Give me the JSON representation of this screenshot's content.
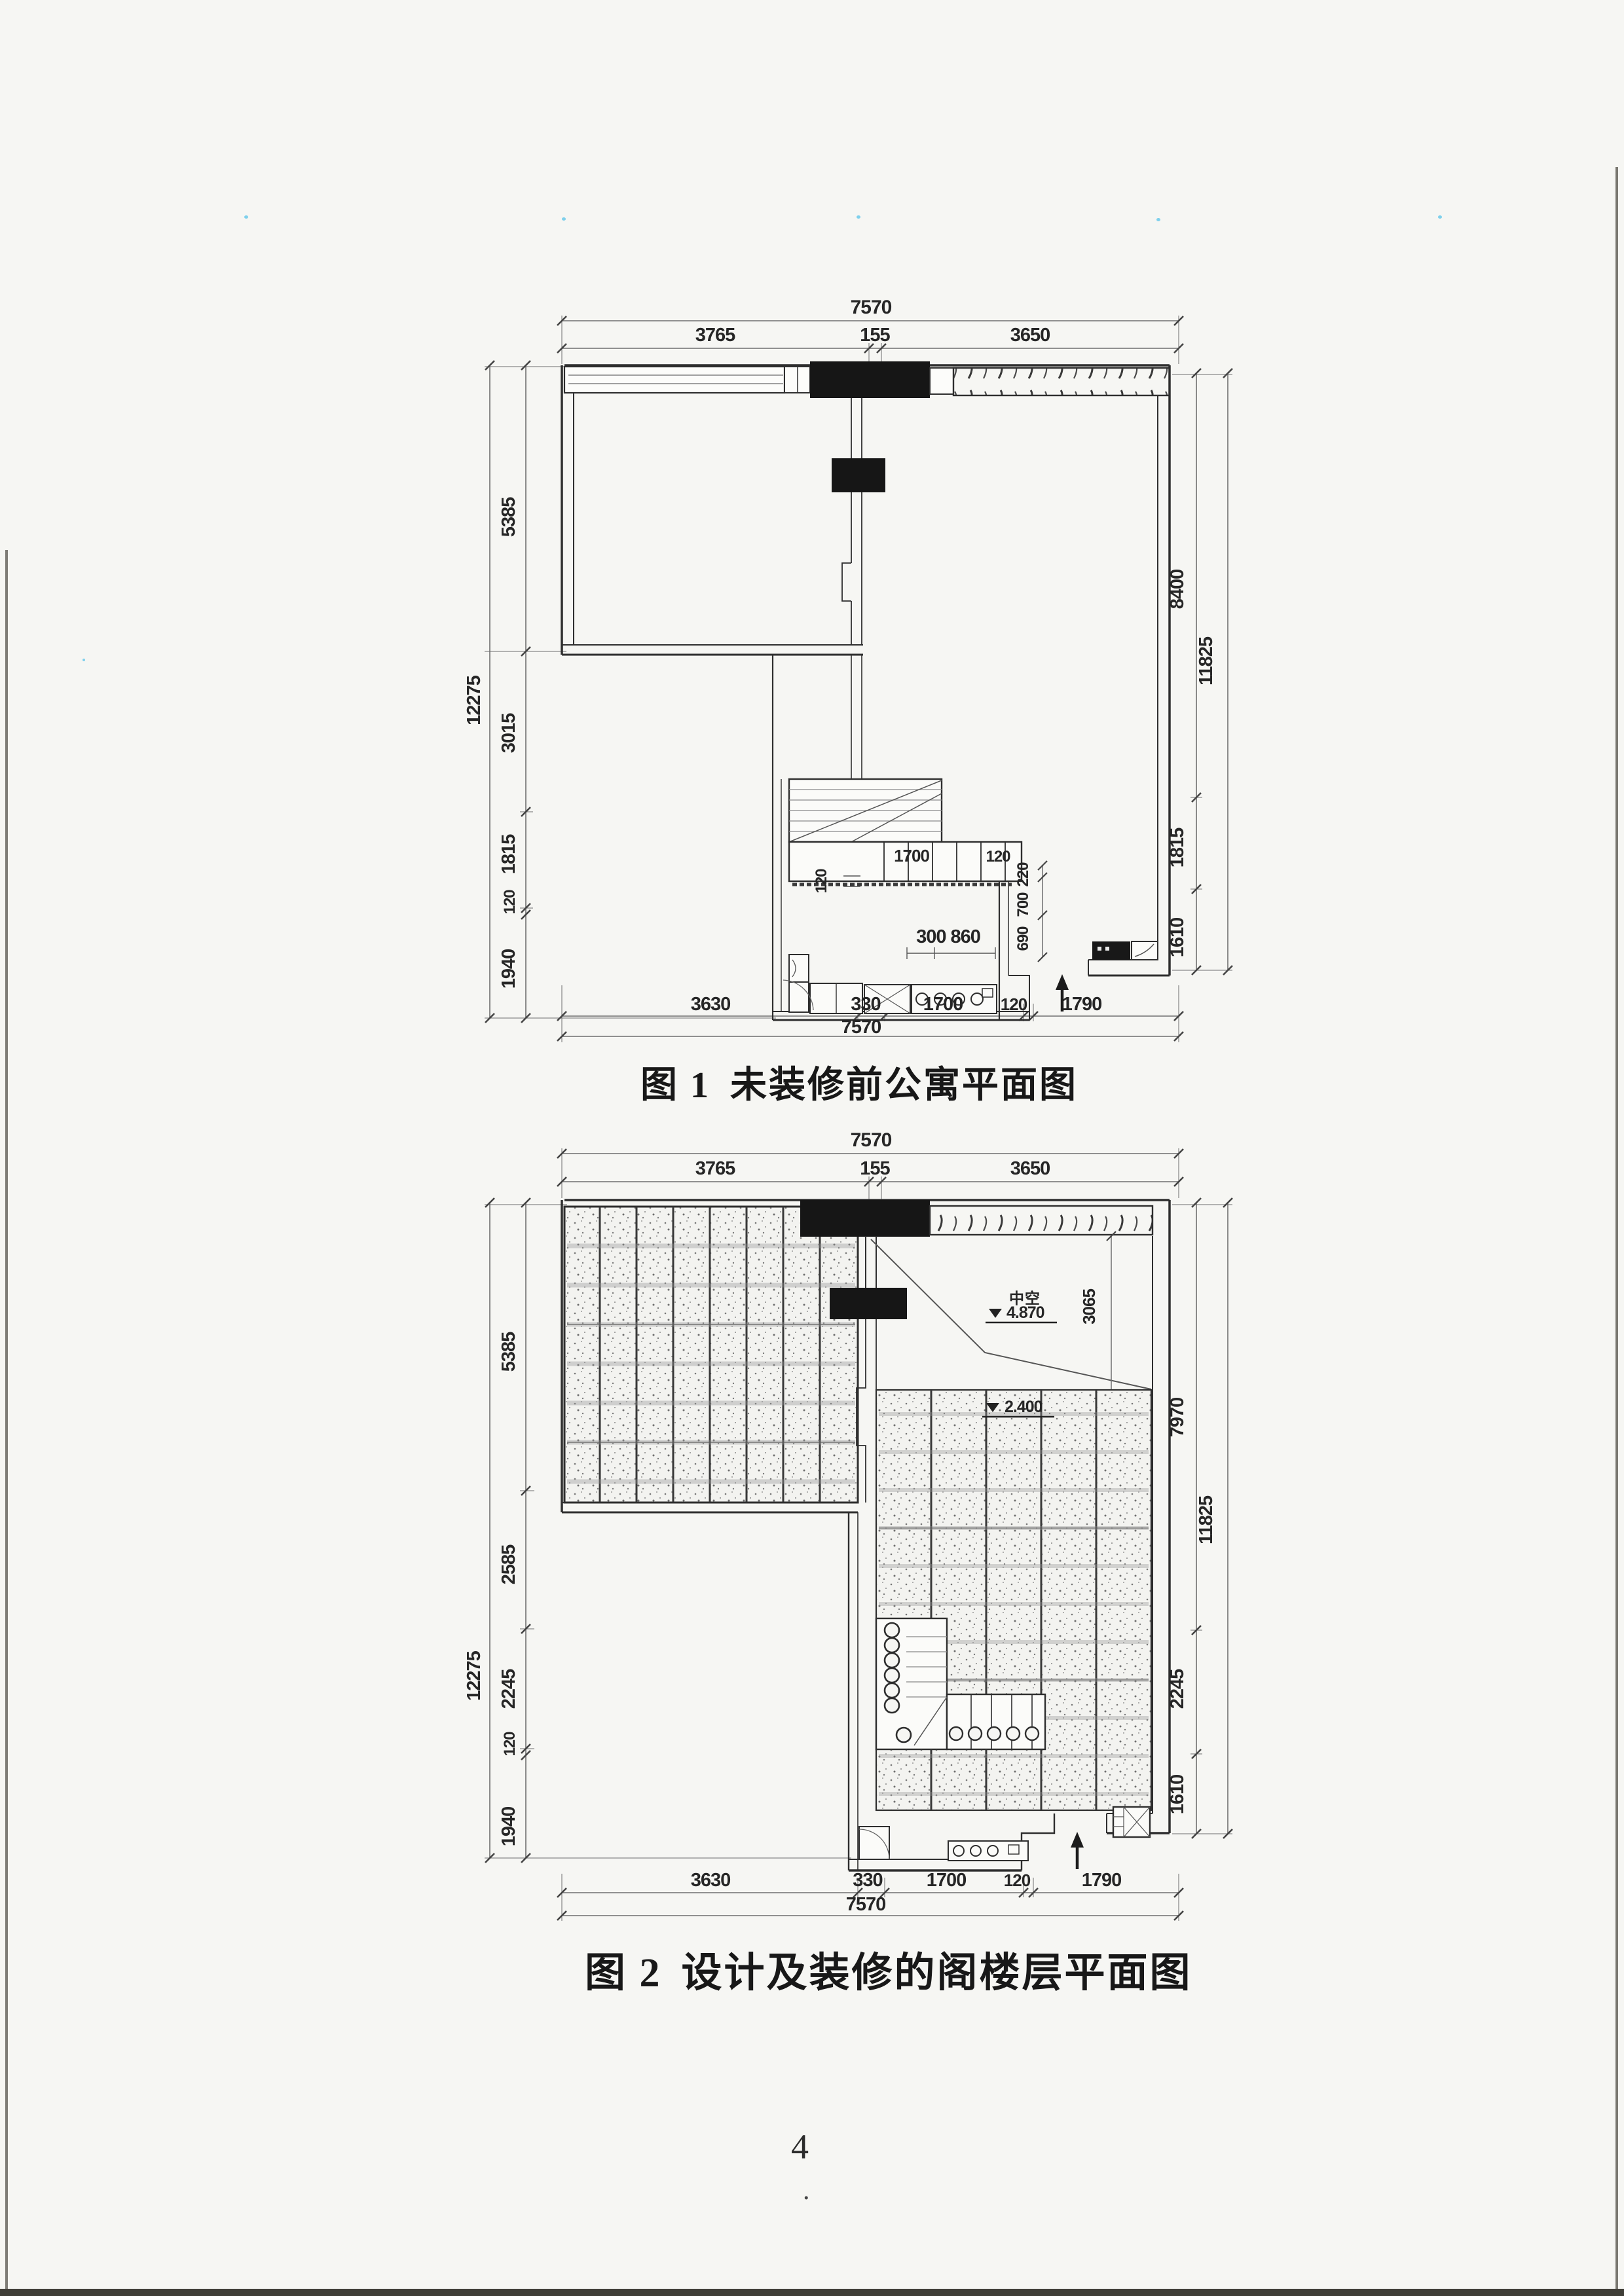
{
  "page": {
    "number": "4",
    "footer_dot": "."
  },
  "figure1": {
    "caption": {
      "prefix": "图 1",
      "title": "未装修前公寓平面图"
    },
    "dims": {
      "top_total": "7570",
      "top_seg1": "3765",
      "top_seg2": "155",
      "top_seg3": "3650",
      "left_total": "12275",
      "left_seg1": "5385",
      "left_seg2": "3015",
      "left_seg3": "1815",
      "left_seg4": "120",
      "left_seg5": "1940",
      "right_total": "11825",
      "right_seg1": "8400",
      "right_seg2": "1815",
      "right_seg3": "1610",
      "bottom_total": "7570",
      "bottom_seg1": "3630",
      "bottom_seg2": "330",
      "bottom_seg3": "1700",
      "bottom_seg4": "120",
      "bottom_seg5": "1790",
      "stair_width": "1700",
      "stair_gap": "120",
      "corridor_gap": "120",
      "cabinet": "300 860",
      "v_seg1": "220",
      "v_seg2": "700",
      "v_seg3": "690"
    }
  },
  "figure2": {
    "caption": {
      "prefix": "图 2",
      "title": "设计及装修的阁楼层平面图"
    },
    "dims": {
      "top_total": "7570",
      "top_seg1": "3765",
      "top_seg2": "155",
      "top_seg3": "3650",
      "left_total": "12275",
      "left_seg1": "5385",
      "left_seg2": "2585",
      "left_seg3": "2245",
      "left_seg4": "120",
      "left_seg5": "1940",
      "right_total": "11825",
      "right_seg1": "7970",
      "right_seg2": "2245",
      "right_seg3": "1610",
      "bottom_total": "7570",
      "bottom_seg1": "3630",
      "bottom_seg2": "330",
      "bottom_seg3": "1700",
      "bottom_seg4": "120",
      "bottom_seg5": "1790",
      "void_height": "3065"
    },
    "annotations": {
      "void_label": "中空",
      "upper_level": "4.870",
      "lower_level": "2.400"
    }
  }
}
